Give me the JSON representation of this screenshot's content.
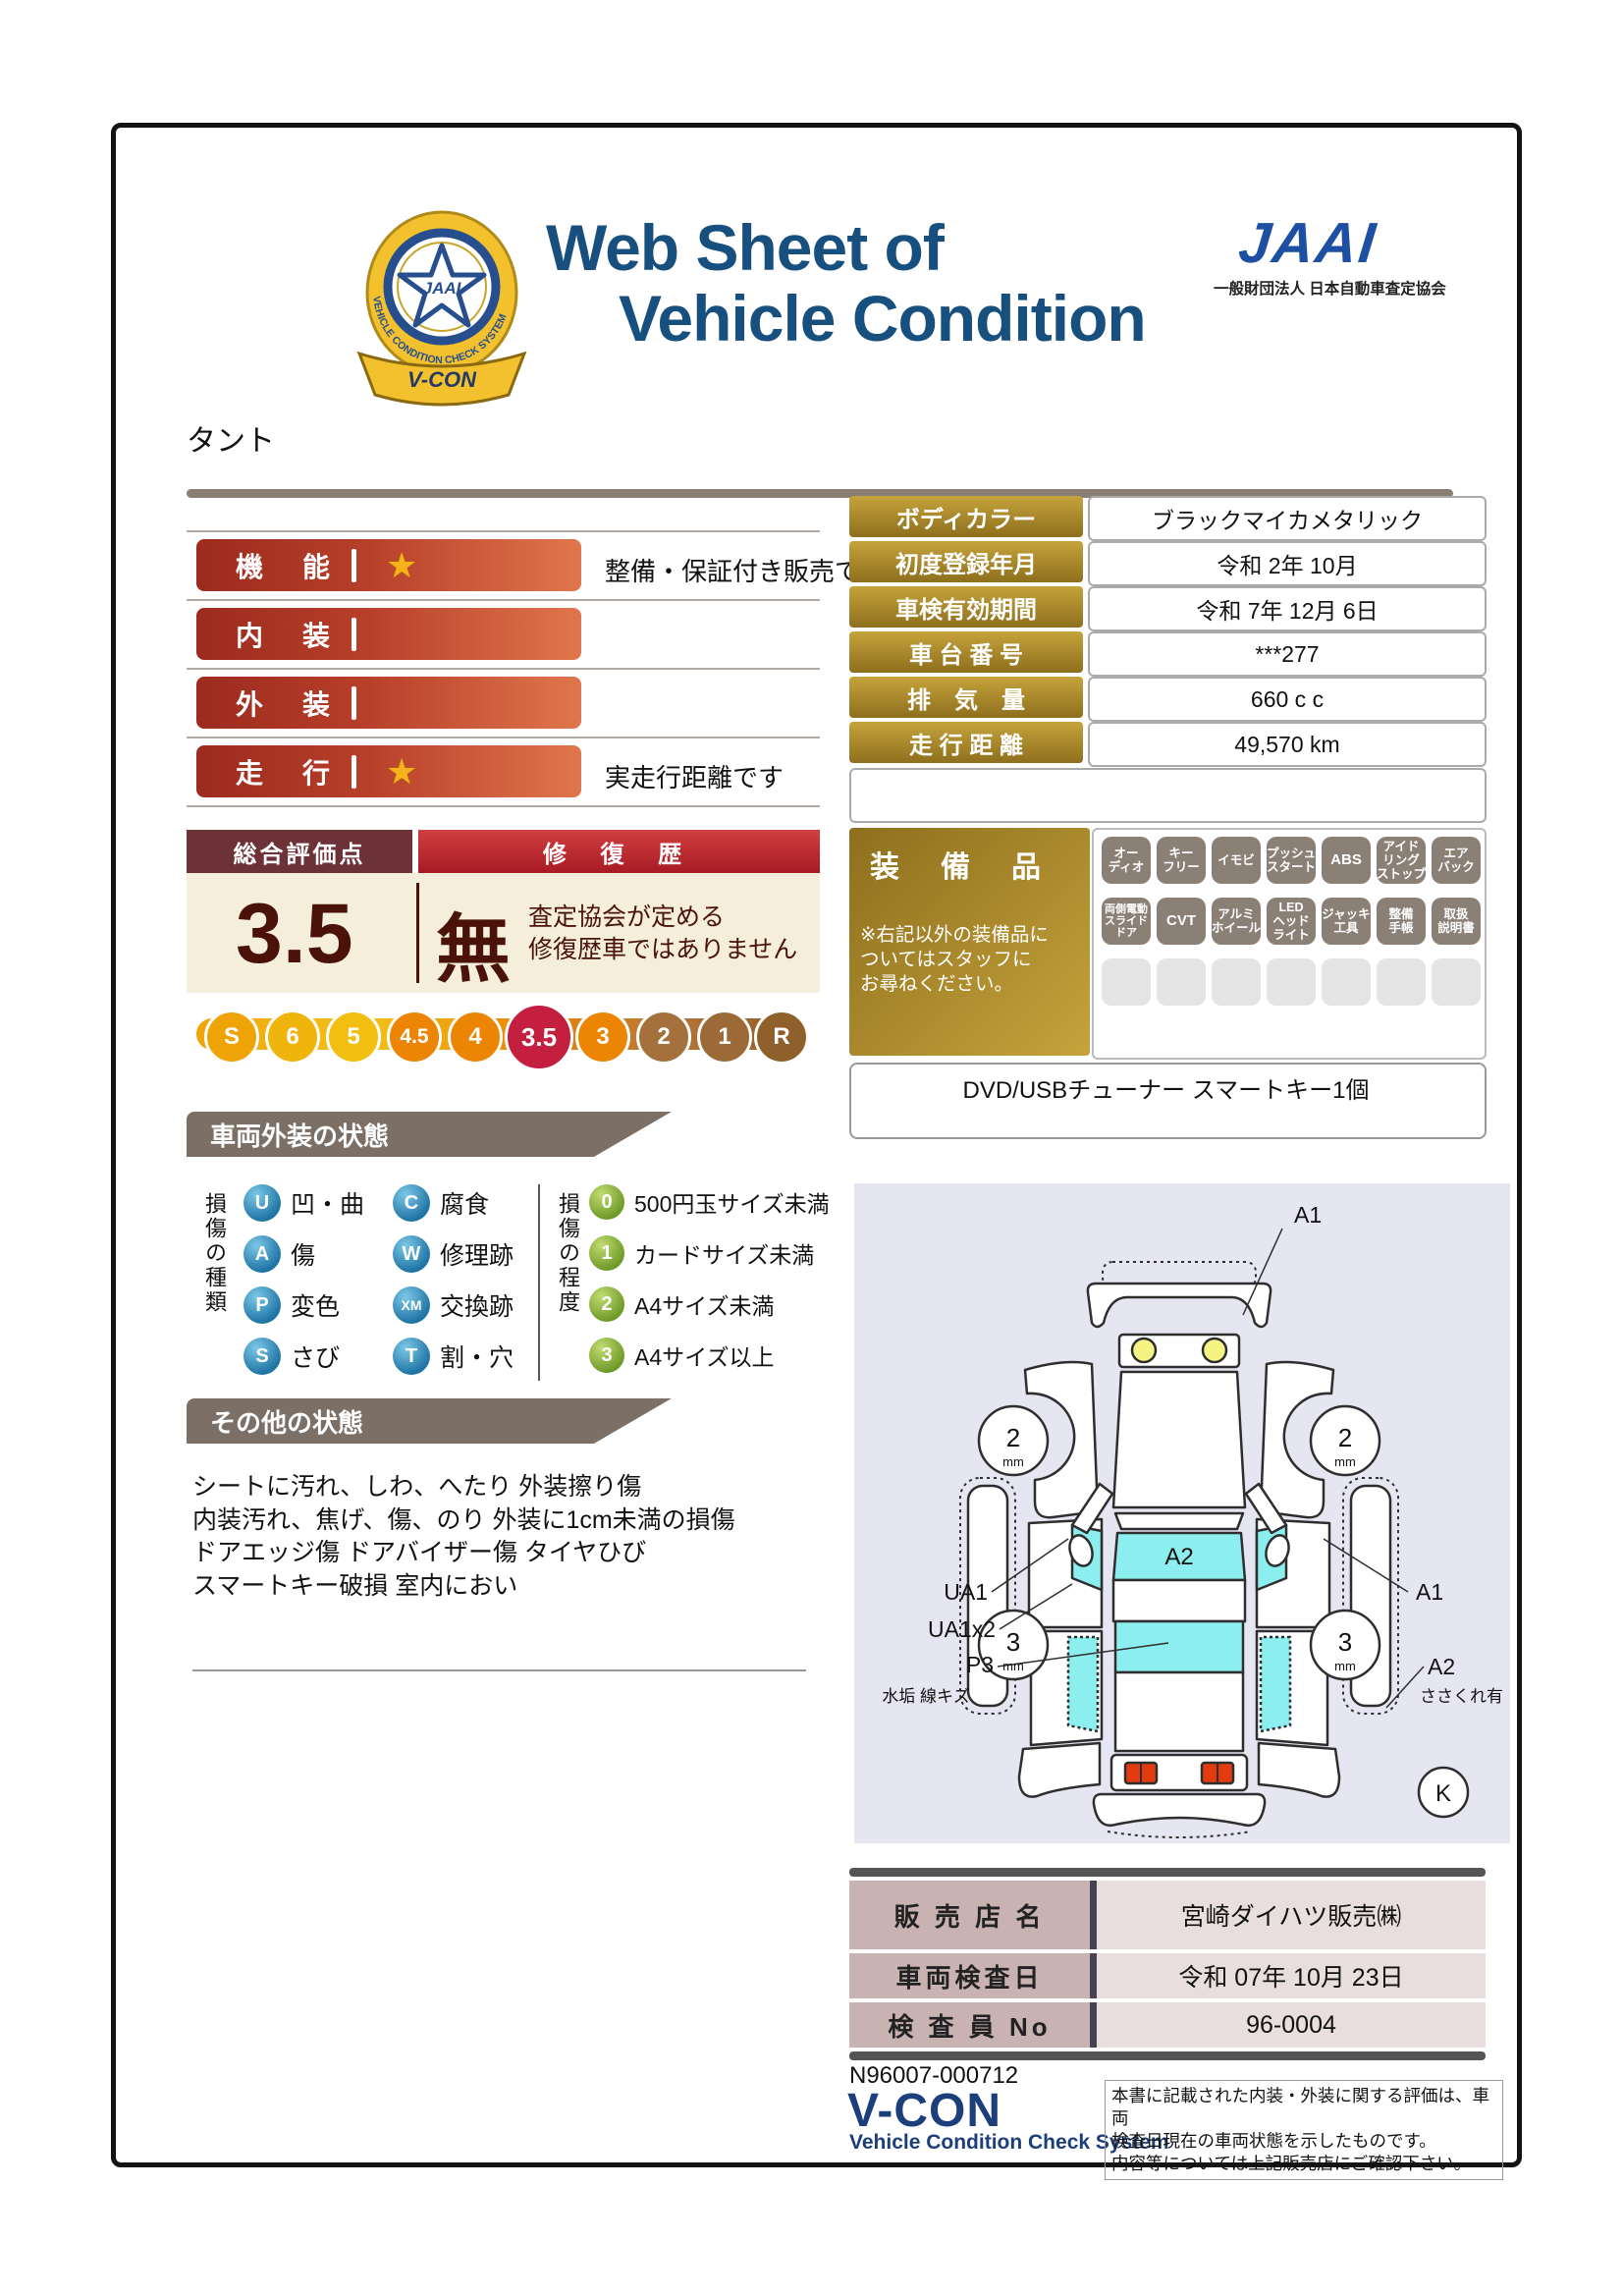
{
  "header": {
    "title_line1": "Web Sheet of",
    "title_line2": "Vehicle Condition",
    "badge": {
      "org": "JAAI",
      "ring_text": "VEHICLE CONDITION CHECK SYSTEM",
      "ribbon": "V-CON"
    },
    "jaai_logo": {
      "logo": "JAAI",
      "subtitle": "一般財団法人 日本自動車査定協会"
    }
  },
  "vehicle_name": "タント",
  "ratings": {
    "rows": [
      {
        "label": "機　能",
        "star": "★",
        "note": "整備・保証付き販売です"
      },
      {
        "label": "内　装",
        "star": "",
        "note": ""
      },
      {
        "label": "外　装",
        "star": "",
        "note": ""
      },
      {
        "label": "走　行",
        "star": "★",
        "note": "実走行距離です"
      }
    ]
  },
  "overall": {
    "score_header": "総合評価点",
    "repair_header": "修 復 歴",
    "score": "3.5",
    "repair_value": "無",
    "repair_note": "査定協会が定める\n修復歴車ではありません"
  },
  "scale": {
    "items": [
      "S",
      "6",
      "5",
      "4.5",
      "4",
      "3.5",
      "3",
      "2",
      "1",
      "R"
    ],
    "selected": "3.5"
  },
  "vehicle_info": {
    "rows": [
      {
        "label": "ボディカラー",
        "value": "ブラックマイカメタリック"
      },
      {
        "label": "初度登録年月",
        "value": "令和 2年 10月"
      },
      {
        "label": "車検有効期間",
        "value": "令和 7年 12月 6日"
      },
      {
        "label": "車 台 番 号",
        "value": "***277"
      },
      {
        "label": "排　気　量",
        "value": "660 c c"
      },
      {
        "label": "走 行 距 離",
        "value": "49,570 km"
      }
    ]
  },
  "equipment": {
    "title": "装　備　品",
    "note": "※右記以外の装備品に\nついてはスタッフに\nお尋ねください。",
    "badges": [
      "オー\nディオ",
      "キー\nフリー",
      "イモビ",
      "プッシュ\nスタート",
      "ABS",
      "アイド\nリング\nストップ",
      "エア\nバック",
      "両側電動\nスライド\nドア",
      "CVT",
      "アルミ\nホイール",
      "LED\nヘッド\nライト",
      "ジャッキ\n工具",
      "整備\n手帳",
      "取扱\n説明書"
    ],
    "extra_note": "DVD/USBチューナー スマートキー1個"
  },
  "exterior": {
    "header": "車両外装の状態",
    "type_legend_title": "損傷の種類",
    "types": [
      {
        "code": "U",
        "label": "凹・曲"
      },
      {
        "code": "A",
        "label": "傷"
      },
      {
        "code": "P",
        "label": "変色"
      },
      {
        "code": "S",
        "label": "さび"
      },
      {
        "code": "C",
        "label": "腐食"
      },
      {
        "code": "W",
        "label": "修理跡"
      },
      {
        "code": "XM",
        "label": "交換跡"
      },
      {
        "code": "T",
        "label": "割・穴"
      }
    ],
    "degree_legend_title": "損傷の程度",
    "degrees": [
      {
        "code": "0",
        "label": "500円玉サイズ未満"
      },
      {
        "code": "1",
        "label": "カードサイズ未満"
      },
      {
        "code": "2",
        "label": "A4サイズ未満"
      },
      {
        "code": "3",
        "label": "A4サイズ以上"
      }
    ]
  },
  "other": {
    "header": "その他の状態",
    "text": "シートに汚れ、しわ、へたり 外装擦り傷\n内装汚れ、焦げ、傷、のり 外装に1cm未満の損傷\nドアエッジ傷 ドアバイザー傷 タイヤひび\nスマートキー破損 室内におい"
  },
  "diagram": {
    "labels": {
      "front_bumper": "A1",
      "windshield": "A2",
      "left_front_door": "UA1",
      "left_rear_door": "UA1x2",
      "roof": "P3",
      "roof_sub": "水垢 線キズ",
      "right_front_door": "A1",
      "right_sill": "A2",
      "right_sill_sub": "ささくれ有",
      "front_tire_depth": "2",
      "rear_tire_depth": "3",
      "tire_unit": "mm",
      "corner_mark": "K"
    }
  },
  "dealer": {
    "rows": [
      {
        "label": "販 売 店 名",
        "value": "宮崎ダイハツ販売㈱"
      },
      {
        "label": "車両検査日",
        "value": "令和 07年 10月 23日"
      },
      {
        "label": "検 査 員 No",
        "value": "96-0004"
      }
    ]
  },
  "footer": {
    "doc_no": "N96007-000712",
    "vcon": "V-CON",
    "vcon_sub": "Vehicle Condition Check System",
    "disclaimer": "本書に記載された内装・外装に関する評価は、車両\n検査日現在の車両状態を示したものです。\n内容等については上記販売店にご確認下さい。"
  },
  "colors": {
    "title_navy": "#17507e",
    "jaai_blue": "#1d50a2",
    "bar_red_dark": "#9c2a1e",
    "bar_red_light": "#e0764c",
    "gold_label": "#8e6f1d",
    "beige": "#f4eeda",
    "score_red": "#4a1208",
    "selected_scale": "#c41f3e",
    "section_taupe": "#7b6f66",
    "glass_cyan": "#8deef0",
    "diagram_bg": "#e6e6f2",
    "mauve": "#c9b2b2"
  }
}
